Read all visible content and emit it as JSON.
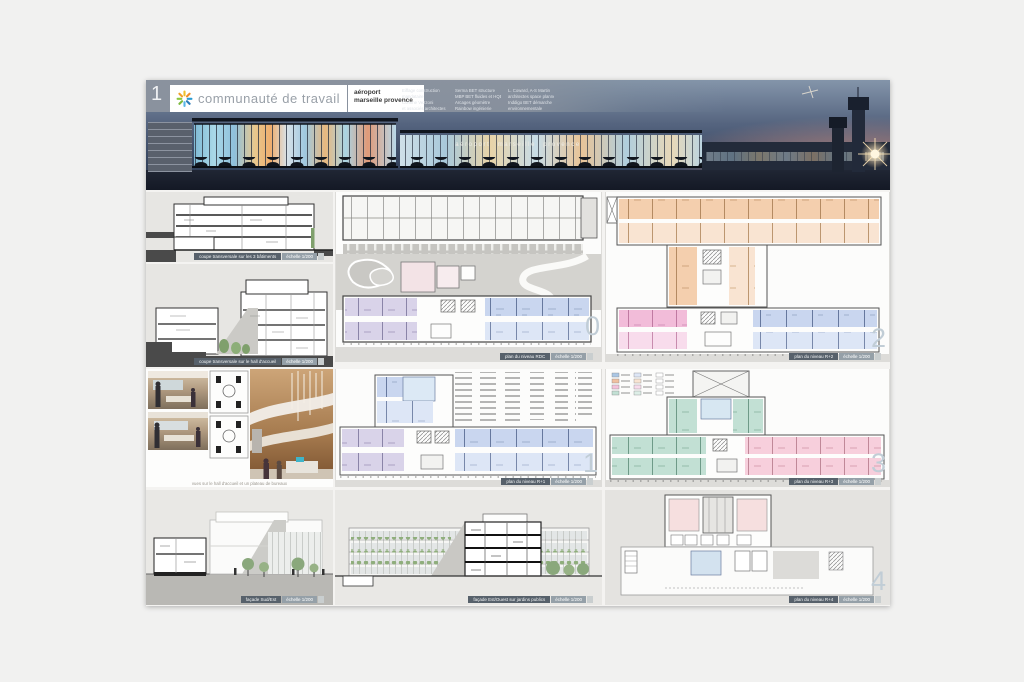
{
  "page": {
    "number": "1"
  },
  "header": {
    "team_name": "communauté de travail",
    "project_line1": "aéroport",
    "project_line2": "marseille provence",
    "credits": [
      {
        "l1": "Eiffage construction",
        "l2": "mandataire",
        "l3": "Corinne Vezzoni",
        "l4": "et associés architectes"
      },
      {
        "l1": "Serma BET structure",
        "l2": "MBP BET fluides et HQE",
        "l3": "Arcages géomètre",
        "l4": "Rainbow ingénierie"
      },
      {
        "l1": "L. Coward, A-S Martin",
        "l2": "architectes space planner",
        "l3": "Inddigo BET démarche",
        "l4": "environnementale"
      }
    ]
  },
  "hero": {
    "sign": "aéroport marseille provence"
  },
  "panels": {
    "section_a": {
      "caption": "coupe transversale sur les 3 bâtiments",
      "scale": "échelle 1/200"
    },
    "section_b": {
      "caption": "coupe transversale sur le hall d'accueil",
      "scale": "échelle 1/200"
    },
    "plan_0": {
      "caption": "plan du niveau RDC",
      "scale": "échelle 1/200",
      "level": "0"
    },
    "plan_1": {
      "caption": "plan du niveau R+1",
      "scale": "échelle 1/200",
      "level": "1"
    },
    "plan_2": {
      "caption": "plan du niveau R+2",
      "scale": "échelle 1/200",
      "level": "2"
    },
    "plan_3": {
      "caption": "plan du niveau R+3",
      "scale": "échelle 1/200",
      "level": "3"
    },
    "plan_4": {
      "caption": "plan du niveau R+4",
      "scale": "échelle 1/200",
      "level": "4"
    },
    "photos": {
      "caption": "vues sur le hall d'accueil et un plateau de bureaux"
    },
    "elevation": {
      "caption": "façade Sud/Est",
      "scale": "échelle 1/200"
    },
    "facade": {
      "caption": "façade Est/Ouest sur jardins publics",
      "scale": "échelle 1/200"
    }
  },
  "colors": {
    "rooms_blue": "#c9d6ef",
    "rooms_purple": "#d9d3e9",
    "rooms_peach": "#f4cfae",
    "rooms_pink": "#f2bcd9",
    "rooms_rose": "#f7cfdc",
    "rooms_teal": "#c2e0d4",
    "caption_dark": "#57616b",
    "caption_light": "#95a0a8",
    "sky": "#55647f"
  }
}
